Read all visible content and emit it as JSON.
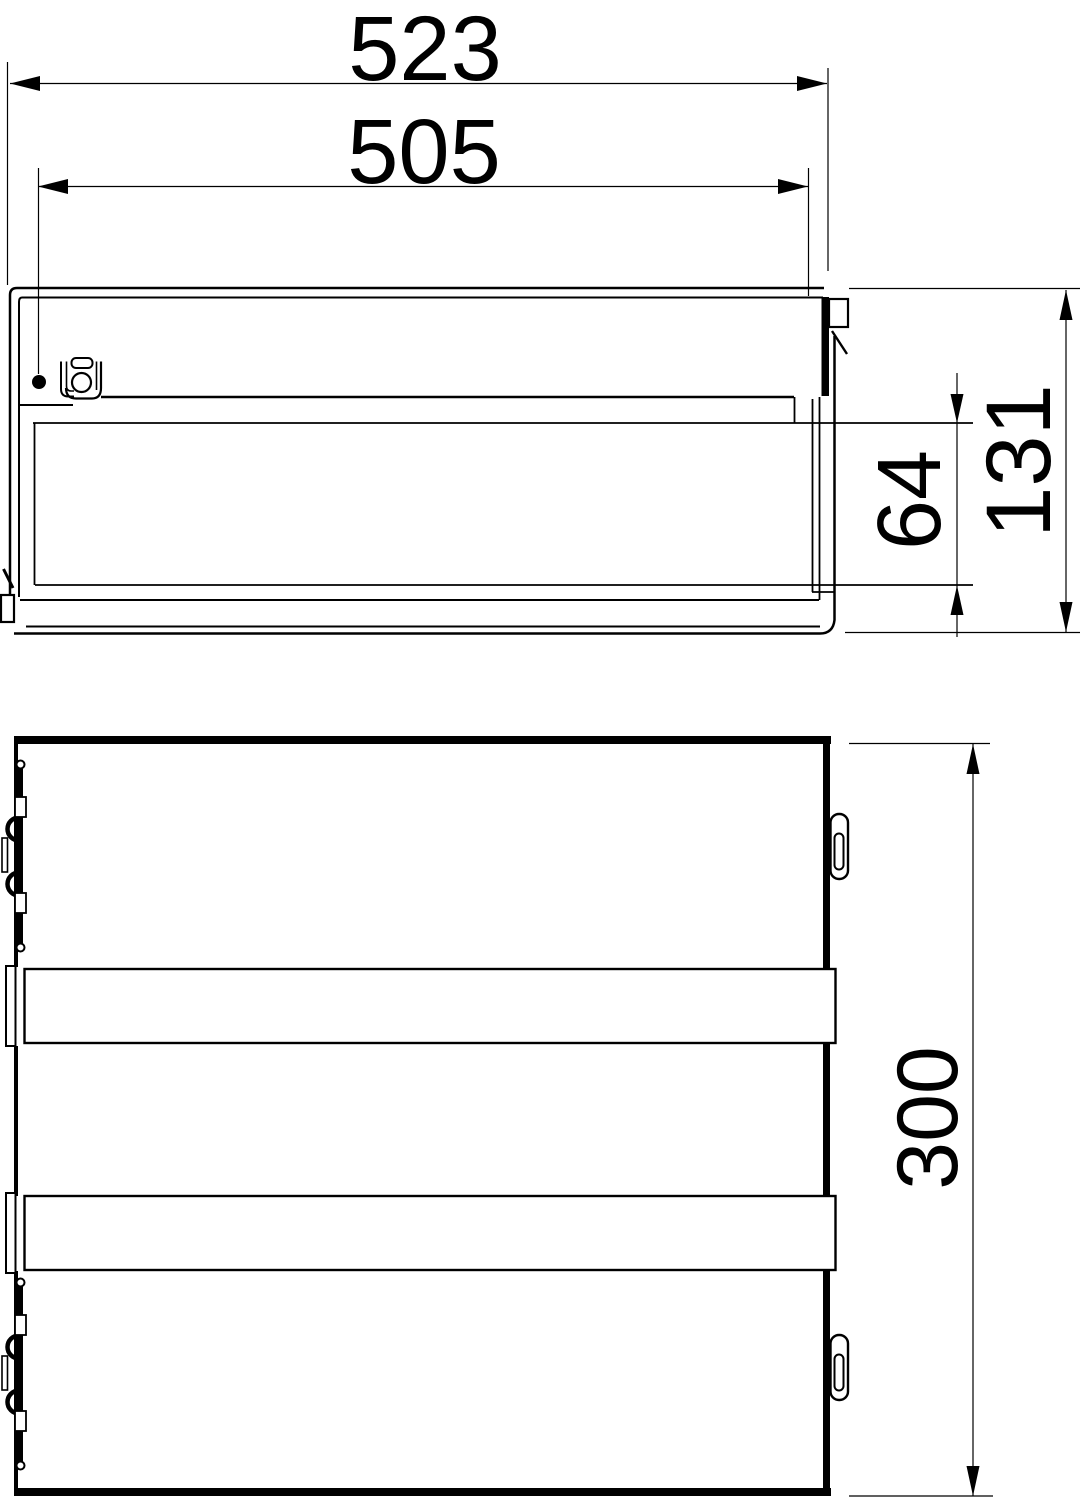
{
  "drawing": {
    "background_color": "#ffffff",
    "line_color": "#000000",
    "dimensions": [
      {
        "name": "overall-width",
        "label": "523",
        "orientation": "horizontal"
      },
      {
        "name": "cover-width",
        "label": "505",
        "orientation": "horizontal"
      },
      {
        "name": "inner-depth",
        "label": "64",
        "orientation": "vertical"
      },
      {
        "name": "overall-height",
        "label": "131",
        "orientation": "vertical"
      },
      {
        "name": "overall-depth",
        "label": "300",
        "orientation": "vertical"
      }
    ]
  }
}
